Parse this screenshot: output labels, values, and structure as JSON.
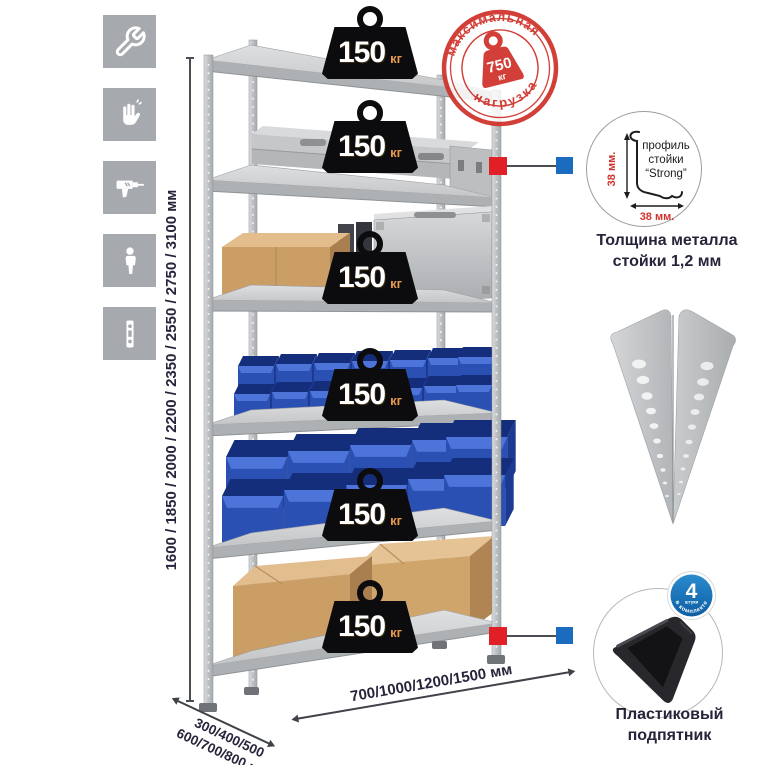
{
  "sidebar_icons": [
    {
      "name": "wrench"
    },
    {
      "name": "gloves"
    },
    {
      "name": "drill"
    },
    {
      "name": "person"
    },
    {
      "name": "post-profile"
    }
  ],
  "rack": {
    "shelf_count": 6,
    "shelf_load": {
      "value": "150",
      "unit": "кг"
    }
  },
  "stamp": {
    "arc_top": "максимальная",
    "arc_bottom": "нагрузка",
    "value": "750",
    "unit": "кг"
  },
  "dimensions": {
    "height": "1600 / 1850 / 2000 / 2200 / 2350 / 2550 / 2750 / 3100 мм",
    "depth_line1": "300/400/500",
    "depth_line2": "600/700/800 мм",
    "width": "700/1000/1200/1500 мм"
  },
  "profile_detail": {
    "label_line1": "профиль",
    "label_line2": "стойки",
    "label_line3": "“Strong”",
    "dim_vertical": "38 мм.",
    "dim_horizontal": "38 мм.",
    "caption_line1": "Толщина металла",
    "caption_line2": "стойки 1,2 мм"
  },
  "foot_detail": {
    "badge_value": "4",
    "badge_sub": "штуки",
    "badge_arc": "в комплекте",
    "caption_line1": "Пластиковый",
    "caption_line2": "подпятник"
  },
  "colors": {
    "accent_red": "#d0342c",
    "callout_red": "#e01f26",
    "callout_blue": "#1b6bbf",
    "bin_blue": "#2b50b4",
    "metal_gray": "#c6c8ca",
    "icon_gray": "#a6aaae",
    "text_dark": "#26243a"
  }
}
